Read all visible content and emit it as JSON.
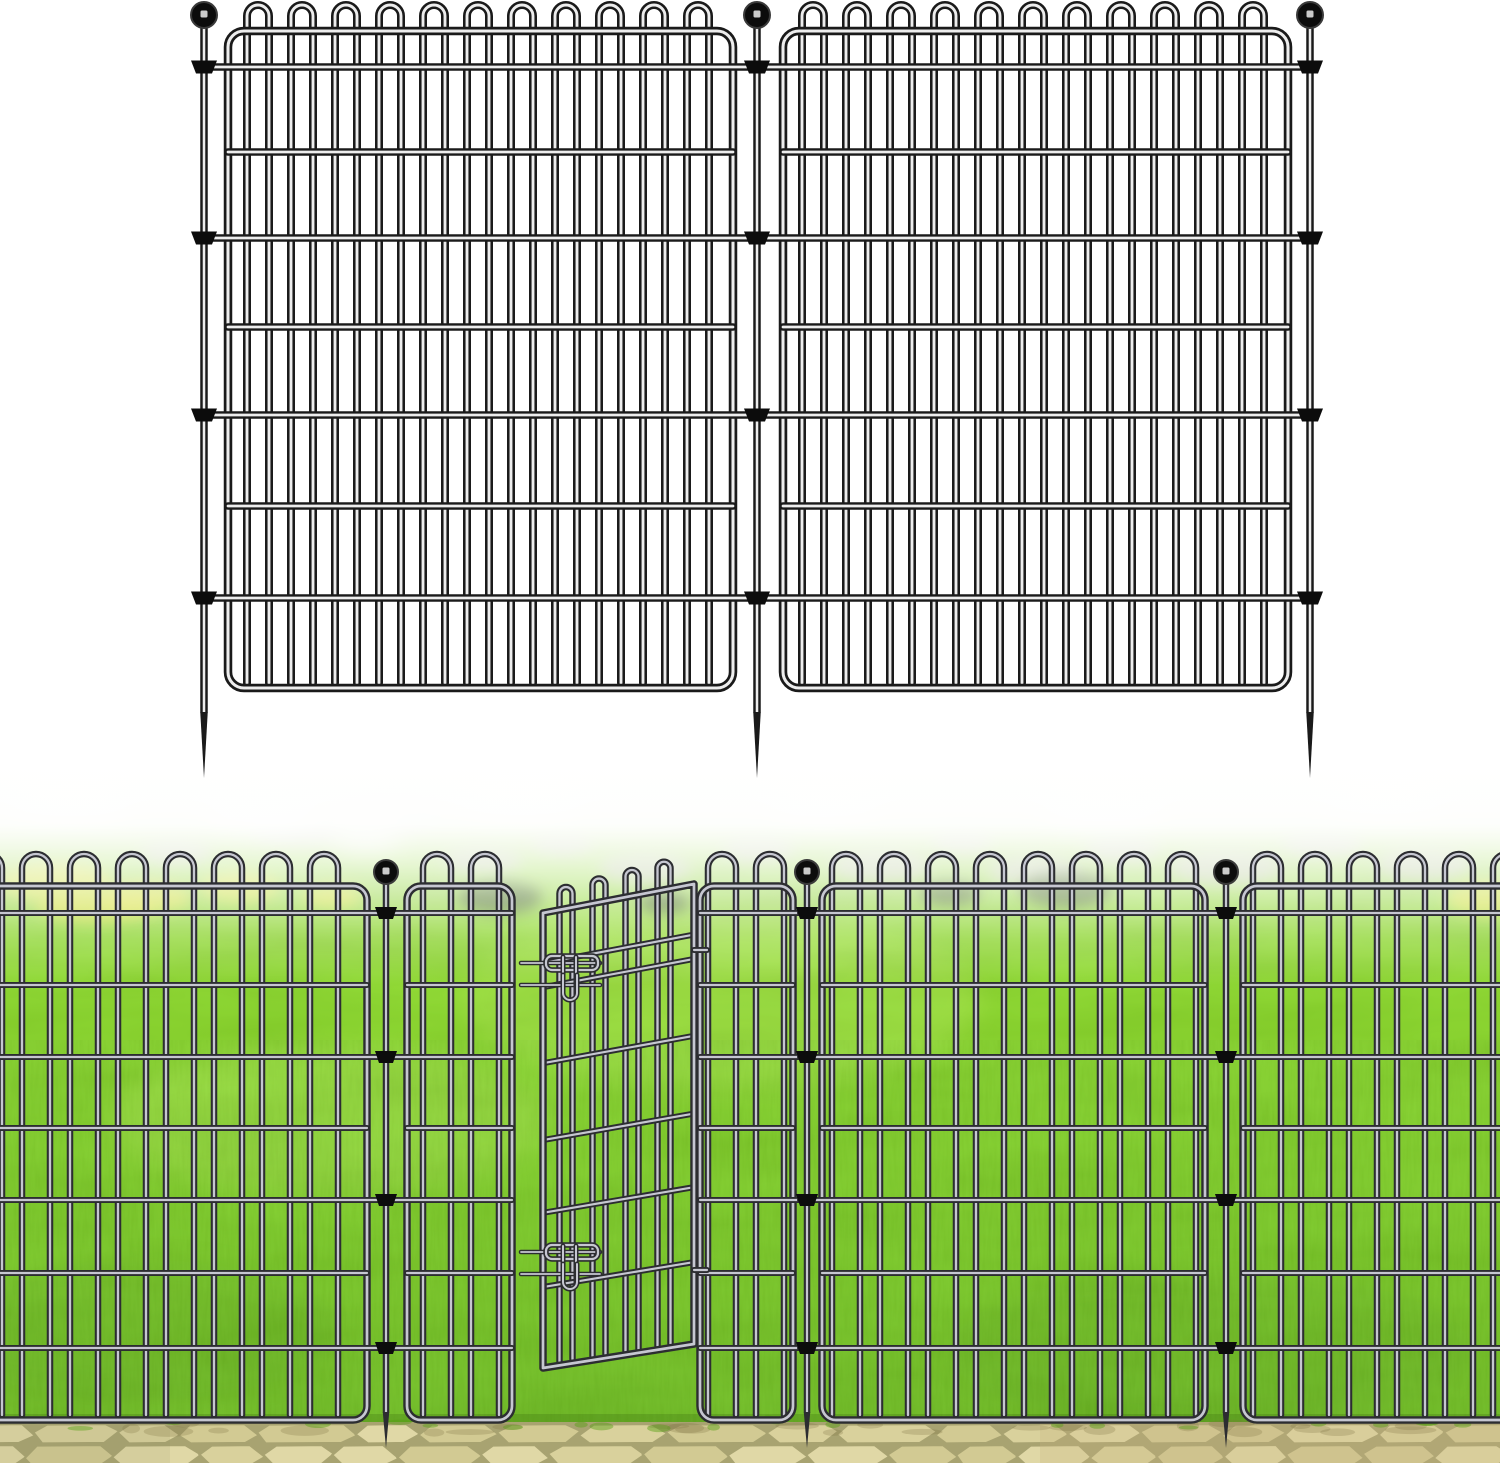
{
  "canvas": {
    "width": 1500,
    "height": 1463,
    "background": "#ffffff"
  },
  "palette": {
    "diagram_wire_outline": "#1a1a1a",
    "diagram_wire_core": "#ededed",
    "scene_wire_outline": "#2c2d31",
    "scene_wire_core": "#c6c7d1",
    "finial": "#0c0c0c",
    "finial_ring": "#3a3a3a",
    "finial_highlight": "#ededed",
    "fog": "#ffffff",
    "grass_gradient": [
      [
        "0",
        "#eef5e0"
      ],
      [
        "0.05",
        "#ddeec2"
      ],
      [
        "0.12",
        "#bce484"
      ],
      [
        "0.18",
        "#9fdc52"
      ],
      [
        "0.26",
        "#8dd52f"
      ],
      [
        "0.4",
        "#81cd22"
      ],
      [
        "0.58",
        "#78c61e"
      ],
      [
        "0.78",
        "#6ebd1a"
      ],
      [
        "1",
        "#61ae16"
      ]
    ],
    "fog_stops": [
      [
        "0",
        "1"
      ],
      [
        "0.3",
        "0.97"
      ],
      [
        "0.55",
        "0.62"
      ],
      [
        "0.8",
        "0.2"
      ],
      [
        "1",
        "0"
      ]
    ],
    "grass_shadow": "#2e5c08",
    "light_patch": "#c6ef70",
    "dark_patch": "#3e7d10",
    "stone_blob": "#c2c8b3",
    "white_cluster": "#f0f2ea",
    "yellow_cluster": "#dce23f",
    "dark_bush": "#3f6020",
    "pavement_gap": "#a8a371",
    "pavement_stones": [
      "#d9d19c",
      "#e0d8a6",
      "#d2ca93"
    ],
    "pavement_tint_right": "#c9b583",
    "pavement_tint_left": "#8c8a60",
    "pavement_dirt": "#7d7040",
    "grass_tuft": "#569f13"
  },
  "diagram": {
    "bg_bottom": 757,
    "wire": {
      "outline_w": 8,
      "rail_w": 7.5,
      "frame_w": 8.5,
      "core_ratio": 0.36
    },
    "frame_top": 31,
    "frame_bottom": 688,
    "corner_radius": 16,
    "loop_pitch": 44,
    "loop_leg_half": 11,
    "loop_arc_y": 16,
    "rail_rows": [
      67,
      152,
      238,
      327,
      415,
      506,
      598
    ],
    "clip_rows": [
      67,
      238,
      415,
      598
    ],
    "rail_ext": 24,
    "panels": [
      {
        "x0": 228,
        "x1": 733,
        "loop_start": 30,
        "ext_left": true,
        "ext_right": true
      },
      {
        "x0": 783,
        "x1": 1288,
        "loop_start": 30,
        "ext_left": true,
        "ext_right": true
      }
    ],
    "stakes": [
      {
        "x": 204
      },
      {
        "x": 757
      },
      {
        "x": 1310
      }
    ],
    "stake": {
      "ball_y": 15,
      "ball_r": 13,
      "shaft_w": 7.5,
      "shaft_bottom": 712,
      "tip_y": 778,
      "clip_top_half": 13,
      "clip_bottom_half": 8,
      "clip_h": 13
    }
  },
  "scene": {
    "top": 755,
    "wire": {
      "outline_w": 6.5,
      "rail_w": 6,
      "frame_w": 7.5,
      "core_ratio": 0.36
    },
    "frame_top": 886,
    "frame_bottom": 1420,
    "corner_radius": 14,
    "loop_pitch": 48,
    "loop_leg_half": 14,
    "loop_arc_y": 868,
    "rail_rows": [
      913,
      985,
      1057,
      1128,
      1200,
      1273,
      1348
    ],
    "clip_rows": [
      913,
      1057,
      1200,
      1348
    ],
    "rail_ext": 22,
    "panels": [
      {
        "x0": -40,
        "x1": 367,
        "loop_start": 28,
        "ext_left": false,
        "ext_right": true
      },
      {
        "x0": 407,
        "x1": 512,
        "loop_start": 30,
        "ext_left": true,
        "ext_right": false
      },
      {
        "x0": 700,
        "x1": 793,
        "loop_start": 22,
        "ext_left": false,
        "ext_right": true
      },
      {
        "x0": 822,
        "x1": 1205,
        "loop_start": 24,
        "ext_left": true,
        "ext_right": true
      },
      {
        "x0": 1243,
        "x1": 1540,
        "loop_start": 24,
        "ext_left": true,
        "ext_right": false
      }
    ],
    "stakes": [
      {
        "x": 386
      },
      {
        "x": 807
      },
      {
        "x": 1226
      }
    ],
    "stake": {
      "ball_y": 872,
      "ball_r": 12,
      "shaft_w": 6.5,
      "shaft_bottom": 1412,
      "tip_y": 1448,
      "clip_top_half": 11,
      "clip_bottom_half": 7,
      "clip_h": 12
    },
    "gate": {
      "left_x": 543,
      "right_x": 694,
      "top_left_y": 913,
      "top_right_y": 884,
      "bottom_left_y": 1368,
      "bottom_right_y": 1344,
      "loop_centers": [
        566,
        599,
        632,
        664
      ],
      "loop_leg_half": 6.5,
      "loop_peak_far": 20,
      "loop_peak_near": 30,
      "row_fractions": [
        0.11,
        0.163,
        0.33,
        0.499,
        0.659,
        0.822
      ],
      "latch_anchor_ys": [
        956,
        1245
      ],
      "latch": {
        "bolt_dy": [
          7,
          29
        ],
        "bolt_x0": 521,
        "bolt_x1": 600,
        "plate_x0": 546,
        "plate_x1": 598,
        "plate_h": 14,
        "bar_xs": [
          563,
          576
        ],
        "bar_len": 40,
        "u_x0": 563,
        "u_x1": 577,
        "u_top_dy": 19,
        "u_bottom_dy": 44
      },
      "hinge_stub_ys": [
        950,
        1270
      ]
    },
    "pavement": {
      "top": 1425,
      "row1": [
        1423,
        1444
      ],
      "row2": [
        1444,
        1468
      ]
    },
    "horizon_stones": [
      [
        175,
        852,
        36,
        12
      ],
      [
        298,
        830,
        46,
        14
      ],
      [
        392,
        814,
        50,
        16
      ],
      [
        482,
        860,
        40,
        13
      ],
      [
        562,
        844,
        30,
        11
      ],
      [
        645,
        868,
        46,
        15
      ],
      [
        758,
        849,
        36,
        13
      ],
      [
        880,
        866,
        50,
        16
      ],
      [
        962,
        841,
        30,
        11
      ],
      [
        1035,
        871,
        46,
        15
      ],
      [
        1122,
        849,
        38,
        13
      ],
      [
        1226,
        867,
        56,
        18
      ],
      [
        1322,
        844,
        40,
        13
      ],
      [
        1424,
        864,
        48,
        16
      ]
    ],
    "white_clusters": [
      [
        70,
        800,
        60,
        20
      ],
      [
        262,
        812,
        55,
        18
      ],
      [
        366,
        836,
        36,
        14
      ],
      [
        520,
        798,
        62,
        20
      ],
      [
        824,
        803,
        56,
        18
      ],
      [
        1104,
        808,
        62,
        20
      ],
      [
        1385,
        798,
        56,
        18
      ]
    ],
    "yellow_clusters": [
      [
        55,
        882,
        56,
        20
      ],
      [
        146,
        897,
        46,
        16
      ],
      [
        240,
        887,
        40,
        15
      ],
      [
        95,
        906,
        60,
        16
      ],
      [
        332,
        896,
        30,
        12
      ],
      [
        1486,
        898,
        40,
        18
      ]
    ],
    "dark_bushes": [
      [
        500,
        897,
        42,
        16
      ],
      [
        664,
        902,
        26,
        11
      ],
      [
        950,
        893,
        30,
        12
      ],
      [
        1066,
        889,
        46,
        18
      ]
    ],
    "light_patches": [
      [
        720,
        1000,
        260,
        90
      ],
      [
        330,
        1120,
        220,
        75
      ]
    ],
    "dark_patches": [
      [
        1210,
        1350,
        260,
        80
      ],
      [
        140,
        1330,
        200,
        70
      ]
    ]
  }
}
